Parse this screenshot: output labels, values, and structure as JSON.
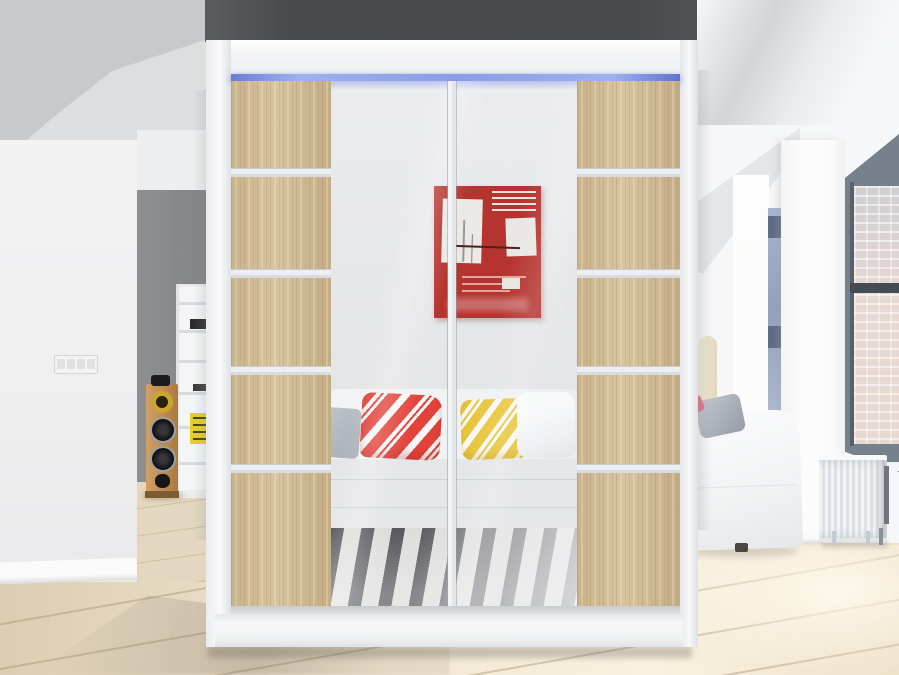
{
  "scene": {
    "type": "interior-product-photo",
    "subject": "two-door sliding wardrobe with mirrored centre panels, oak side panels and blue LED top light, standing in a bright room",
    "wardrobe": {
      "frame_color": "#f2f3f4",
      "led_strip_color": "#7b8fe0",
      "wood_panel_color": "#d2bc94",
      "divider_strip_color": "#eceef0",
      "doors": 2,
      "wood_segments_per_panel": 5,
      "mirror_reflection": [
        "red abstract painting with white shapes",
        "white tufted sofa",
        "gray pillow",
        "red-white striped pillow",
        "yellow-white striped pillow",
        "white pillow",
        "black-white striped rug"
      ]
    },
    "room_left": {
      "accent_wall_color": "#85878a",
      "objects": [
        "white shelf unit",
        "yellow box",
        "dark books",
        "wooden tower speaker",
        "light switch"
      ]
    },
    "room_right": {
      "objects": [
        "tall window with brick view",
        "blue-gray window frame",
        "white radiator",
        "white sofa with gray pillow",
        "pink accent",
        "floor lamp"
      ],
      "window_frame_color": "#76818c",
      "brick_color": "#e7d8d2"
    },
    "colors": {
      "back_wall_band": "#474a4c",
      "floor": "#ece0c9",
      "painting_red": "#b5342f",
      "pillow_red": "#e2423a",
      "pillow_yellow": "#e9c53c",
      "rug_dark": "#3f4147",
      "rug_light": "#d9d8d6"
    }
  }
}
